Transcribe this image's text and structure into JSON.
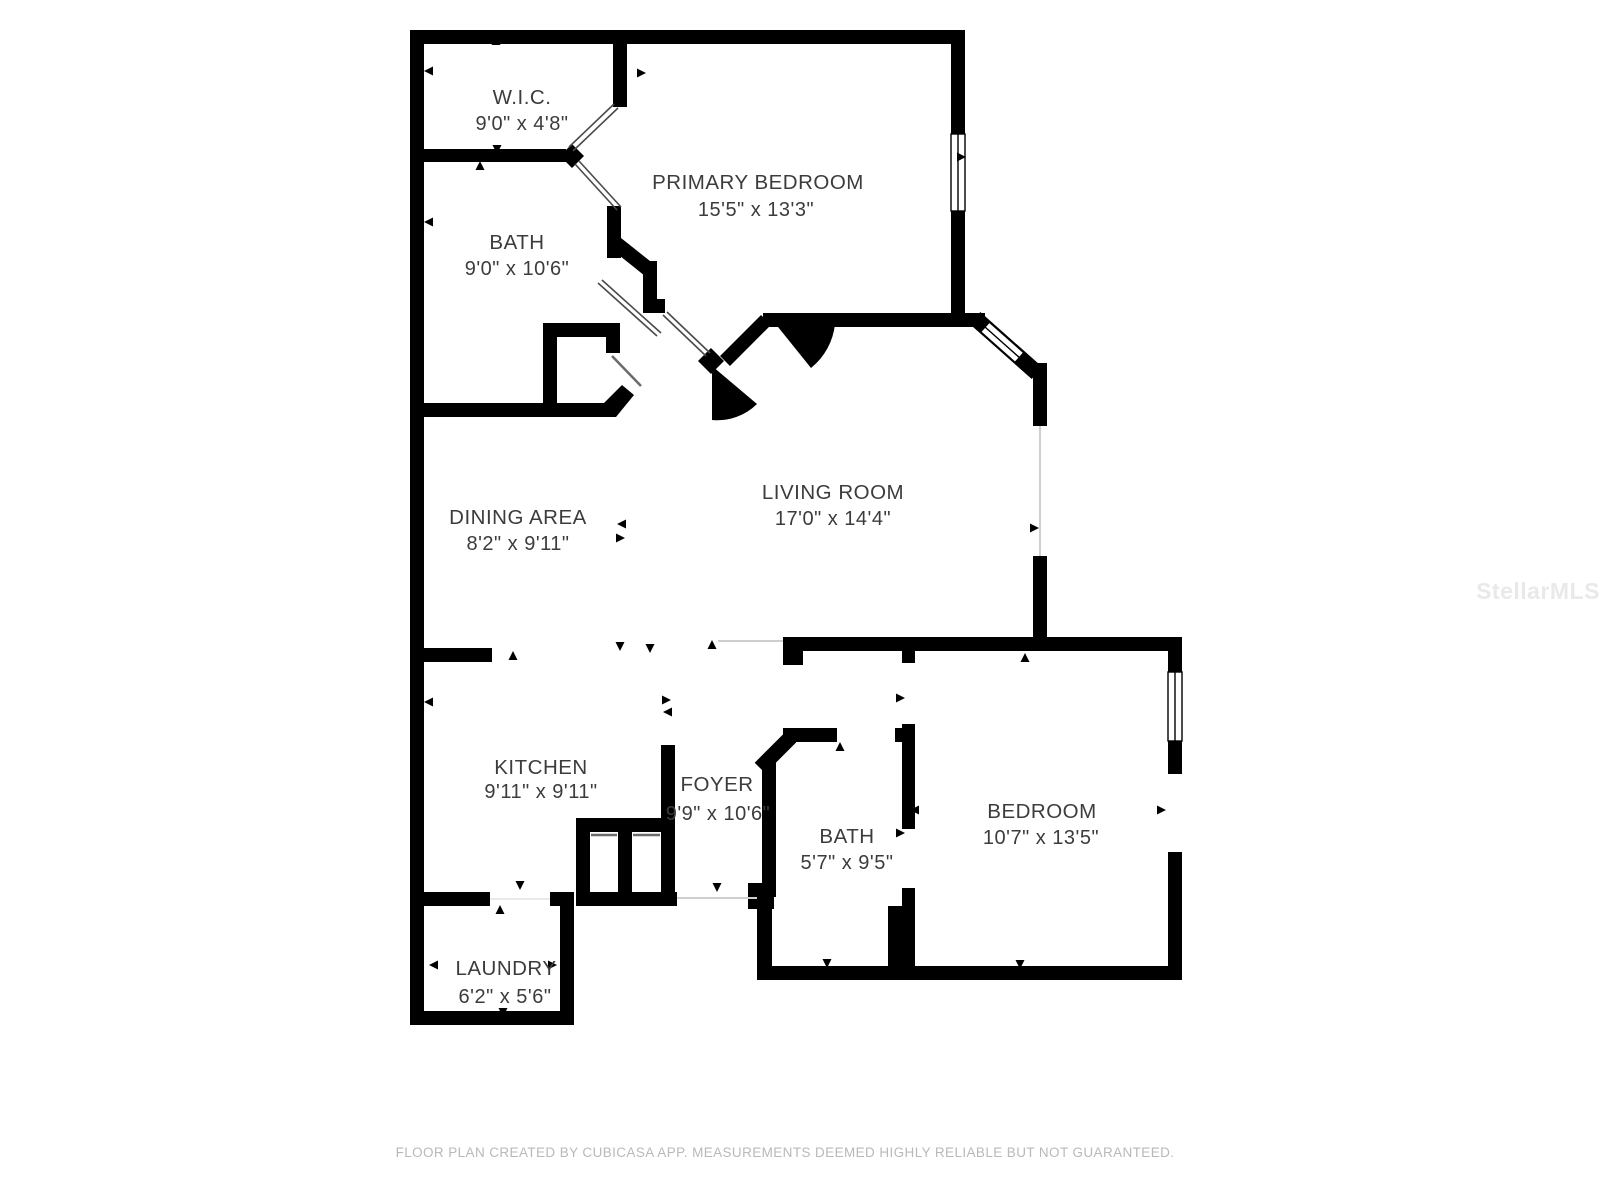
{
  "rooms": [
    {
      "id": "wic",
      "name": "W.I.C.",
      "dimensions": "9'0\" x 4'8\""
    },
    {
      "id": "primary-bedroom",
      "name": "PRIMARY BEDROOM",
      "dimensions": "15'5\" x 13'3\""
    },
    {
      "id": "primary-bath",
      "name": "BATH",
      "dimensions": "9'0\" x 10'6\""
    },
    {
      "id": "dining-area",
      "name": "DINING AREA",
      "dimensions": "8'2\" x 9'11\""
    },
    {
      "id": "living-room",
      "name": "LIVING ROOM",
      "dimensions": "17'0\" x 14'4\""
    },
    {
      "id": "kitchen",
      "name": "KITCHEN",
      "dimensions": "9'11\" x 9'11\""
    },
    {
      "id": "foyer",
      "name": "FOYER",
      "dimensions": "9'9\" x 10'6\""
    },
    {
      "id": "bath-2",
      "name": "BATH",
      "dimensions": "5'7\" x 9'5\""
    },
    {
      "id": "bedroom",
      "name": "BEDROOM",
      "dimensions": "10'7\" x 13'5\""
    },
    {
      "id": "laundry",
      "name": "LAUNDRY",
      "dimensions": "6'2\" x 5'6\""
    }
  ],
  "footer": {
    "text": "FLOOR PLAN CREATED BY CUBICASA APP. MEASUREMENTS DEEMED HIGHLY RELIABLE BUT NOT GUARANTEED."
  },
  "watermark": {
    "text": "StellarMLS"
  },
  "colors": {
    "wall": "#000000",
    "background": "#ffffff",
    "label": "#3c3c3c",
    "threshold": "#cfcfcf",
    "footer": "#b9b9b9",
    "watermark": "#e9e9e9"
  }
}
